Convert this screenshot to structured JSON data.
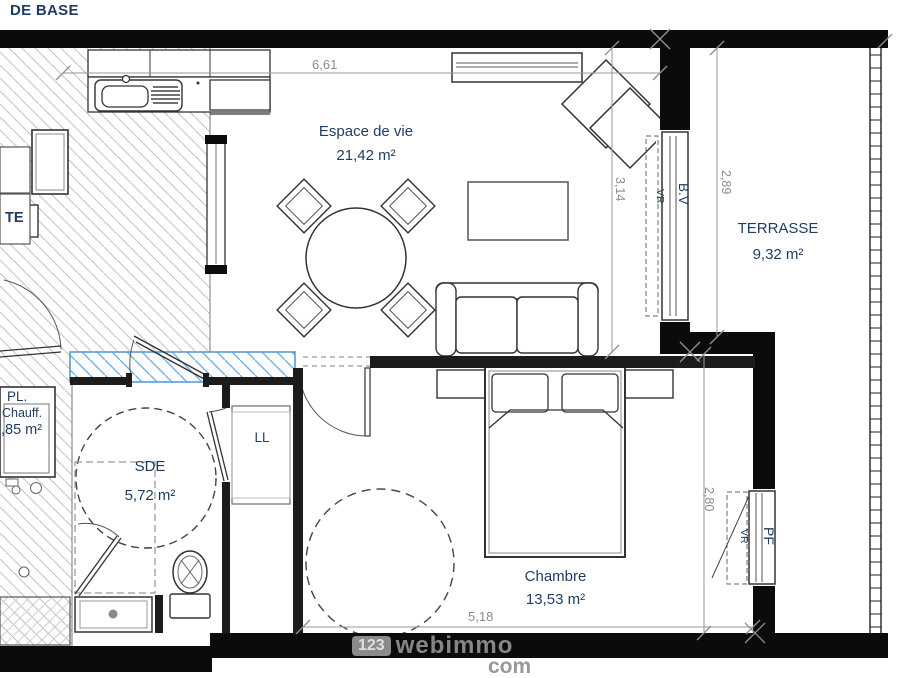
{
  "title": "DE BASE",
  "rooms": {
    "living": {
      "name": "Espace de vie",
      "area": "21,42 m²"
    },
    "terrace": {
      "name": "TERRASSE",
      "area": "9,32 m²"
    },
    "shower_room": {
      "name": "SDE",
      "area": "5,72 m²"
    },
    "bedroom": {
      "name": "Chambre",
      "area": "13,53 m²"
    },
    "closet": {
      "name": "PL.",
      "detail": "Chauff.",
      "area": ",85 m²"
    },
    "entry": {
      "name": "TE"
    }
  },
  "fixtures": {
    "washing_machine": "LL"
  },
  "openings": {
    "bay_window": "B.V",
    "bay_window_shutter": "VR",
    "french_window": "PF",
    "french_window_shutter": "VR"
  },
  "dimensions": {
    "living_width": "6,61",
    "living_depth": "3,14",
    "terrace_depth": "2,89",
    "bedroom_depth": "2,80",
    "bedroom_width": "5,18"
  },
  "watermark": {
    "prefix": "123",
    "name": "webimmo",
    "suffix": "com"
  },
  "colors": {
    "label": "#1d3c5f",
    "dimension": "#8c8c8c",
    "wall": "#0b0b0b",
    "blue_hatch": "#5b9bd5"
  }
}
